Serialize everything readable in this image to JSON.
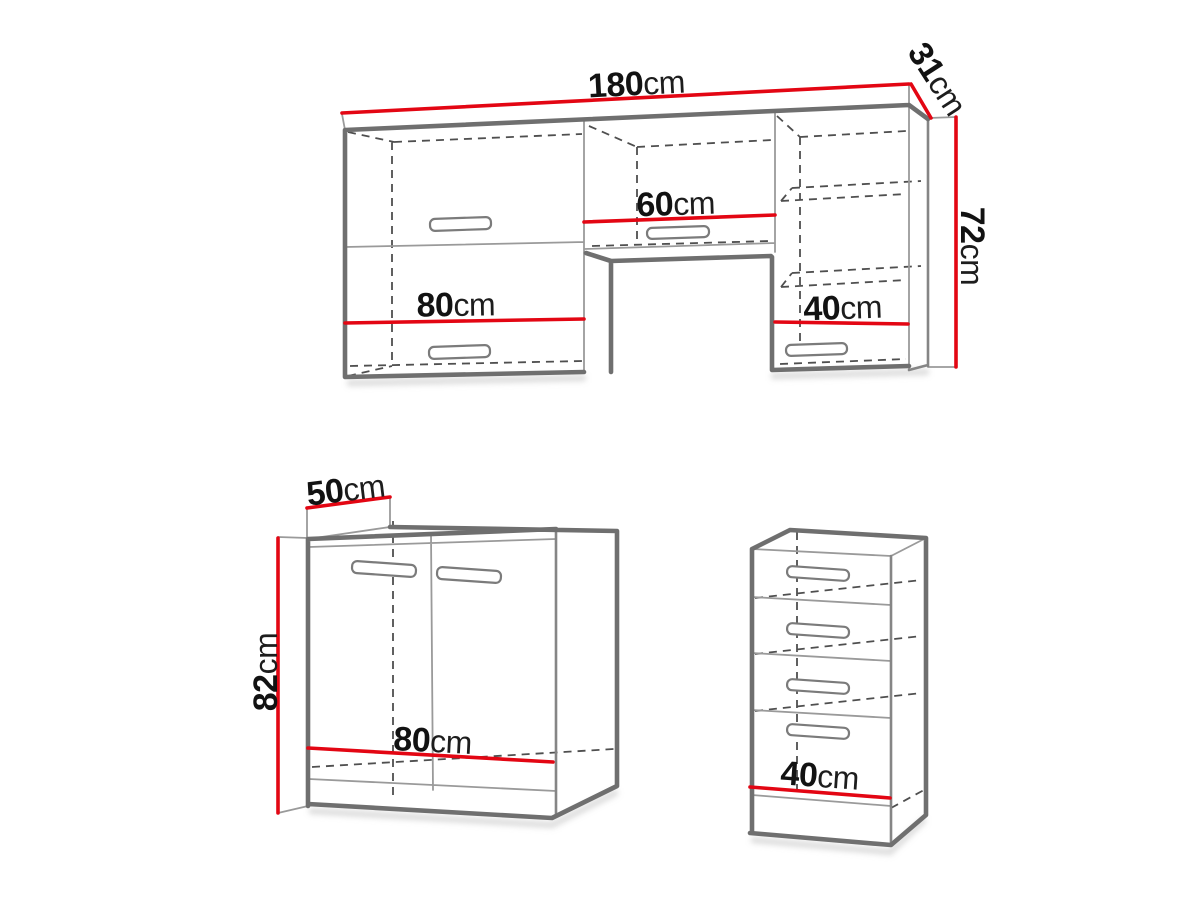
{
  "figure": "furniture-dimension-diagram",
  "colors": {
    "dimension_red": "#e30613",
    "outline_gray": "#6f6f6f",
    "text_black": "#121212"
  },
  "labels": {
    "wall": {
      "width": {
        "value": "180",
        "unit": "cm"
      },
      "depth": {
        "value": "31",
        "unit": "cm"
      },
      "height": {
        "value": "72",
        "unit": "cm"
      },
      "left_section": {
        "value": "80",
        "unit": "cm"
      },
      "middle_section": {
        "value": "60",
        "unit": "cm"
      },
      "right_section": {
        "value": "40",
        "unit": "cm"
      }
    },
    "base": {
      "depth": {
        "value": "50",
        "unit": "cm"
      },
      "height": {
        "value": "82",
        "unit": "cm"
      },
      "width": {
        "value": "80",
        "unit": "cm"
      }
    },
    "drawer": {
      "width": {
        "value": "40",
        "unit": "cm"
      }
    }
  }
}
